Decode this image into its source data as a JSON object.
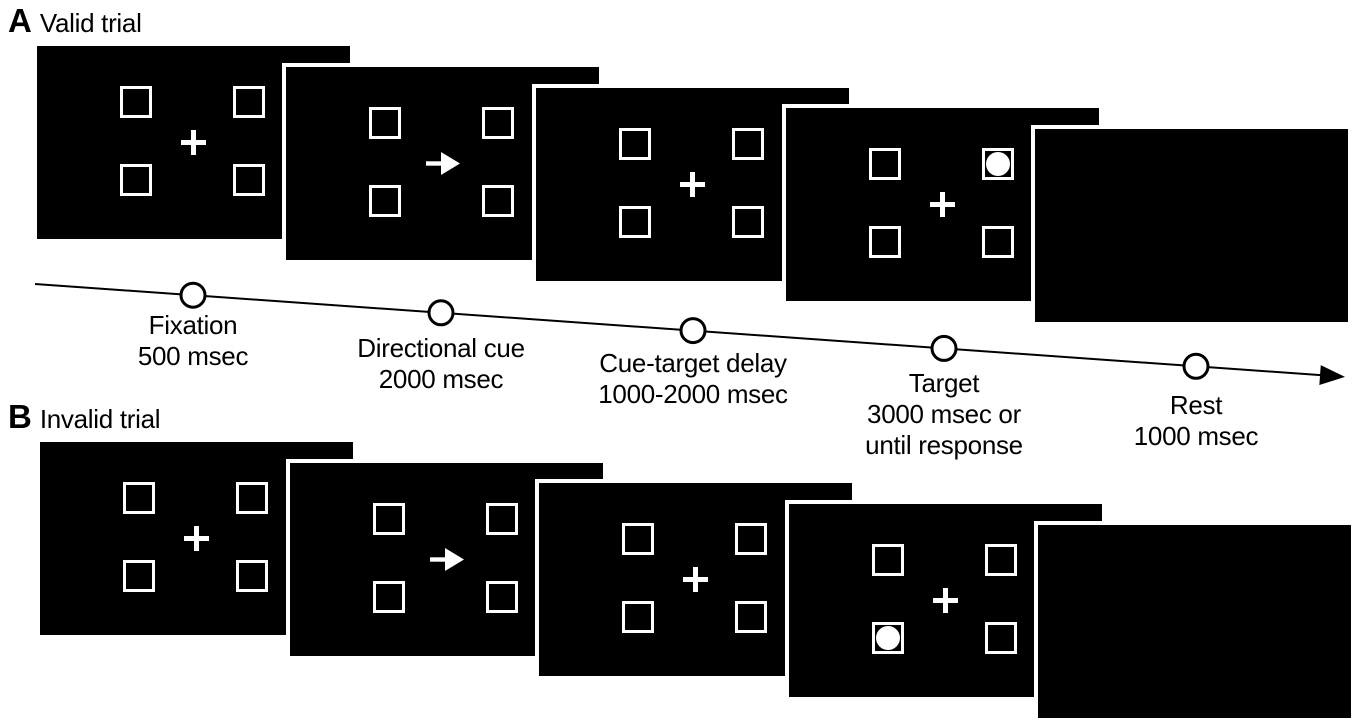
{
  "colors": {
    "page_background": "#ffffff",
    "screen_background": "#000000",
    "stimulus": "#ffffff",
    "text": "#000000",
    "timeline_line": "#000000"
  },
  "figure": {
    "panels": [
      {
        "letter": "A",
        "title": "Valid trial",
        "label_x": 8,
        "label_y": 2,
        "screens": [
          {
            "type": "fixation",
            "x": 37,
            "y": 46
          },
          {
            "type": "cue",
            "x": 286,
            "y": 67,
            "cue_direction": "right"
          },
          {
            "type": "delay",
            "x": 536,
            "y": 88
          },
          {
            "type": "target",
            "x": 786,
            "y": 108,
            "target_square": "top-right"
          },
          {
            "type": "rest",
            "x": 1035,
            "y": 129
          }
        ]
      },
      {
        "letter": "B",
        "title": "Invalid trial",
        "label_x": 8,
        "label_y": 398,
        "screens": [
          {
            "type": "fixation",
            "x": 40,
            "y": 442
          },
          {
            "type": "cue",
            "x": 290,
            "y": 463,
            "cue_direction": "right"
          },
          {
            "type": "delay",
            "x": 539,
            "y": 483
          },
          {
            "type": "target",
            "x": 789,
            "y": 504,
            "target_square": "bottom-left"
          },
          {
            "type": "rest",
            "x": 1038,
            "y": 525
          }
        ]
      }
    ]
  },
  "timeline": {
    "start": {
      "x": 35,
      "y": 284
    },
    "end": {
      "x": 1340,
      "y": 376.5
    },
    "stages": [
      {
        "cx": 193,
        "label_top": 310,
        "lines": [
          "Fixation",
          "500 msec"
        ]
      },
      {
        "cx": 441,
        "label_top": 333,
        "lines": [
          "Directional cue",
          "2000 msec"
        ]
      },
      {
        "cx": 693,
        "label_top": 348,
        "lines": [
          "Cue-target delay",
          "1000-2000 msec"
        ]
      },
      {
        "cx": 944,
        "label_top": 368,
        "lines": [
          "Target",
          "3000 msec or",
          "until response"
        ]
      },
      {
        "cx": 1196,
        "label_top": 390,
        "lines": [
          "Rest",
          "1000 msec"
        ]
      }
    ]
  }
}
